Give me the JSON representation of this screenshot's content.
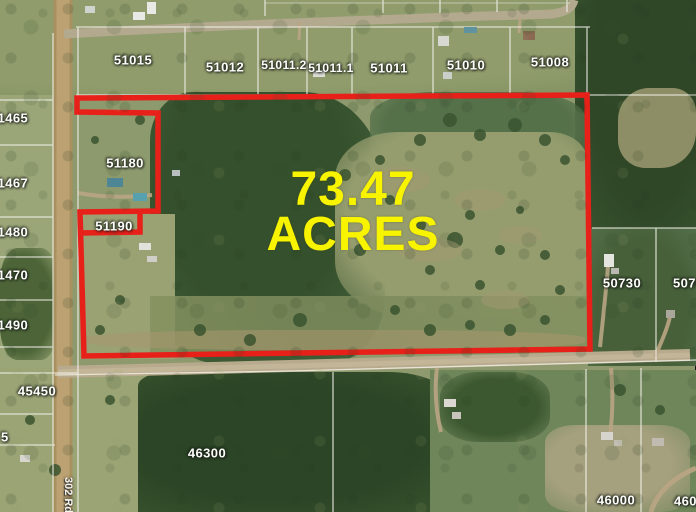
{
  "map": {
    "acreage": {
      "value": "73.47",
      "unit": "ACRES"
    },
    "road_label": "302 Rd",
    "parcel_labels": {
      "top": [
        "51015",
        "51012",
        "51011.2",
        "51011.1",
        "51011",
        "51010",
        "51008"
      ],
      "left": [
        "51465",
        "51467",
        "51480",
        "51470",
        "51490",
        "45450",
        "5"
      ],
      "center": [
        "51180",
        "51190"
      ],
      "right": [
        "50730",
        "50740"
      ],
      "bottom": [
        "46300",
        "46000",
        "46010"
      ]
    },
    "colors": {
      "boundary": "#e8201a",
      "acreage_text": "#f8f400",
      "parcel_label_text": "#fdfdfa"
    }
  }
}
